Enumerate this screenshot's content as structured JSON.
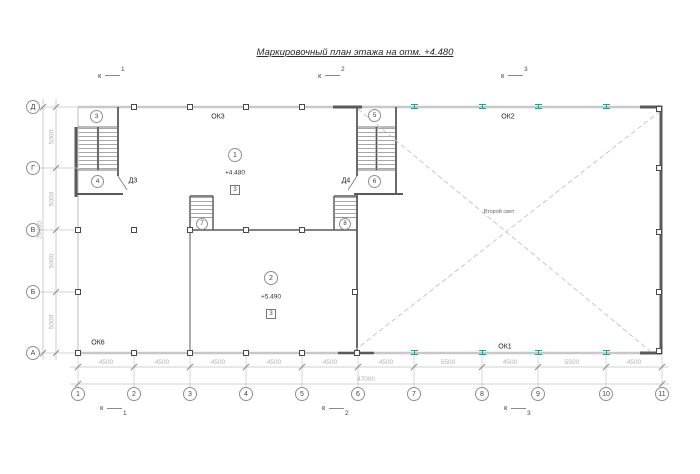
{
  "title": "Маркировочный план этажа на отм. +4.480",
  "sections": {
    "top": [
      {
        "k": "к",
        "n": "1"
      },
      {
        "k": "к",
        "n": "2"
      },
      {
        "k": "к",
        "n": "3"
      }
    ],
    "bottom": [
      {
        "k": "к",
        "n": "1"
      },
      {
        "k": "к",
        "n": "2"
      },
      {
        "k": "к",
        "n": "3"
      }
    ]
  },
  "axes": {
    "rows": [
      {
        "label": "Д"
      },
      {
        "label": "Г"
      },
      {
        "label": "В"
      },
      {
        "label": "Б"
      },
      {
        "label": "А"
      }
    ],
    "columns": [
      {
        "label": "1"
      },
      {
        "label": "2"
      },
      {
        "label": "3"
      },
      {
        "label": "4"
      },
      {
        "label": "5"
      },
      {
        "label": "6"
      },
      {
        "label": "7"
      },
      {
        "label": "8"
      },
      {
        "label": "9"
      },
      {
        "label": "10"
      },
      {
        "label": "11"
      }
    ]
  },
  "dimensions": {
    "bottom_segments": [
      "4500",
      "4500",
      "4500",
      "4500",
      "4500",
      "4500",
      "5500",
      "4500",
      "5500",
      "4500"
    ],
    "bottom_total": "47000",
    "left_segments": [
      "5000",
      "5000",
      "5000",
      "5000"
    ],
    "left_total": "20000"
  },
  "windows": {
    "ok1": "ОК1",
    "ok2": "ОК2",
    "ok3": "ОК3",
    "ok6": "ОК6"
  },
  "doors": {
    "d3": "Д3",
    "d4": "Д4"
  },
  "rooms": [
    {
      "number": "1",
      "elevation": "+4.480",
      "finish": "3"
    },
    {
      "number": "2",
      "elevation": "+5.490",
      "finish": "3"
    }
  ],
  "stairs": [
    {
      "number": "3"
    },
    {
      "number": "4"
    },
    {
      "number": "5"
    },
    {
      "number": "6"
    },
    {
      "number": "7"
    },
    {
      "number": "8"
    }
  ],
  "annotations": {
    "second_light": "Второй свет"
  },
  "colors": {
    "wall_dark": "#5a5a5a",
    "wall_light": "#c8c8c8",
    "dimension": "#b2b2b2",
    "steel_accent": "#2e9a9a"
  }
}
